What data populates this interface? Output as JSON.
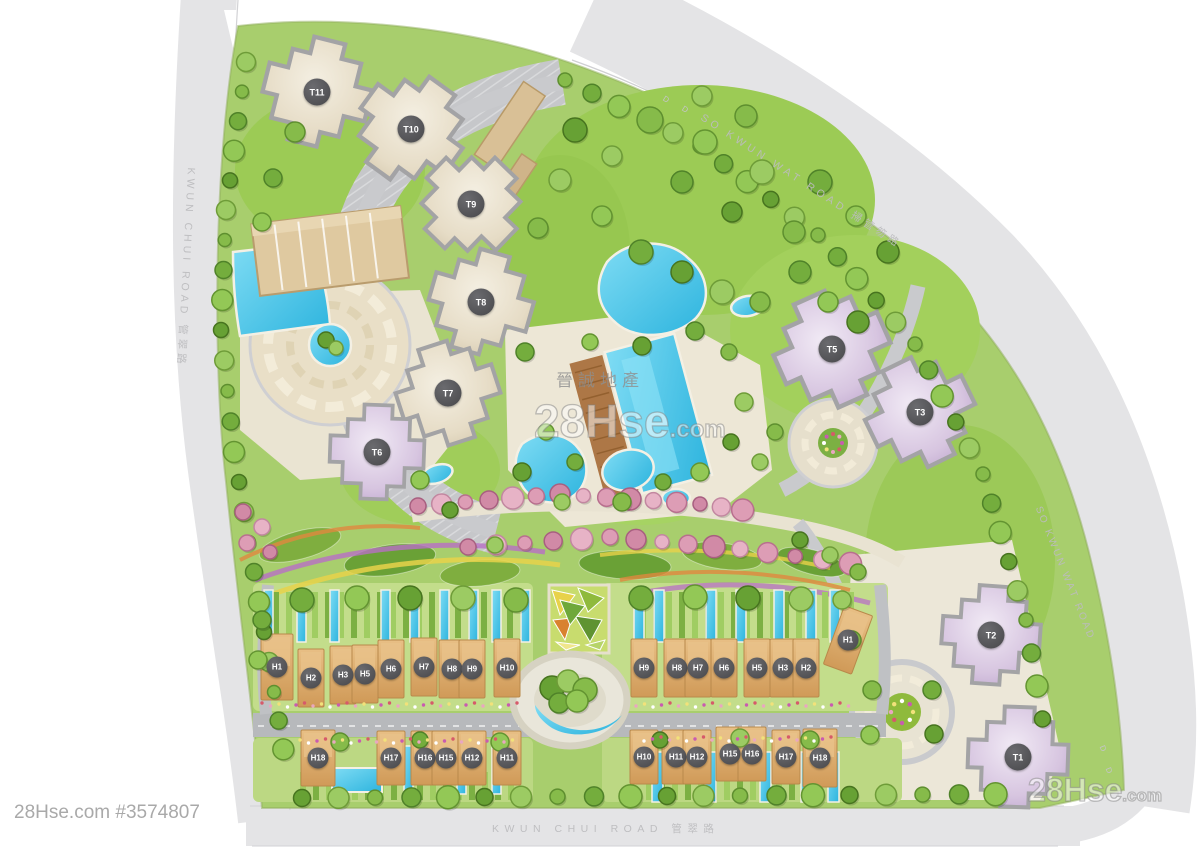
{
  "site": {
    "towers": [
      "T11",
      "T10",
      "T9",
      "T8",
      "T7",
      "T6",
      "T5",
      "T3",
      "T2",
      "T1"
    ],
    "houses_west_north": [
      "H1",
      "H2",
      "H3",
      "H5",
      "H6",
      "H7",
      "H8",
      "H9",
      "H10"
    ],
    "houses_east_north": [
      "H9",
      "H8",
      "H7",
      "H6",
      "H5",
      "H3",
      "H2",
      "H1"
    ],
    "houses_west_south": [
      "H18",
      "H17",
      "H16",
      "H15",
      "H12",
      "H11"
    ],
    "houses_east_south": [
      "H10",
      "H11",
      "H12",
      "H15",
      "H16",
      "H17",
      "H18"
    ]
  },
  "roads": {
    "left_label": "KWUN CHUI ROAD 管翠路",
    "top_right_label": "SO KWUN WAT ROAD 掃管笏路",
    "right_label": "SO KWUN WAT ROAD",
    "bottom_label": "KWUN CHUI ROAD 管翠路",
    "marker": "D"
  },
  "watermarks": {
    "listing_id": "28Hse.com #3574807",
    "brand": "28Hse",
    "brand_suffix": ".com",
    "agency": "晉誠地產"
  },
  "colors": {
    "lawn": "#a8ce6d",
    "pool": "#3cc3ea",
    "road": "#e4e4e6",
    "tower_beige": "#e9e1cf",
    "tower_purple": "#d6c4e0",
    "house": "#dcab6e"
  }
}
